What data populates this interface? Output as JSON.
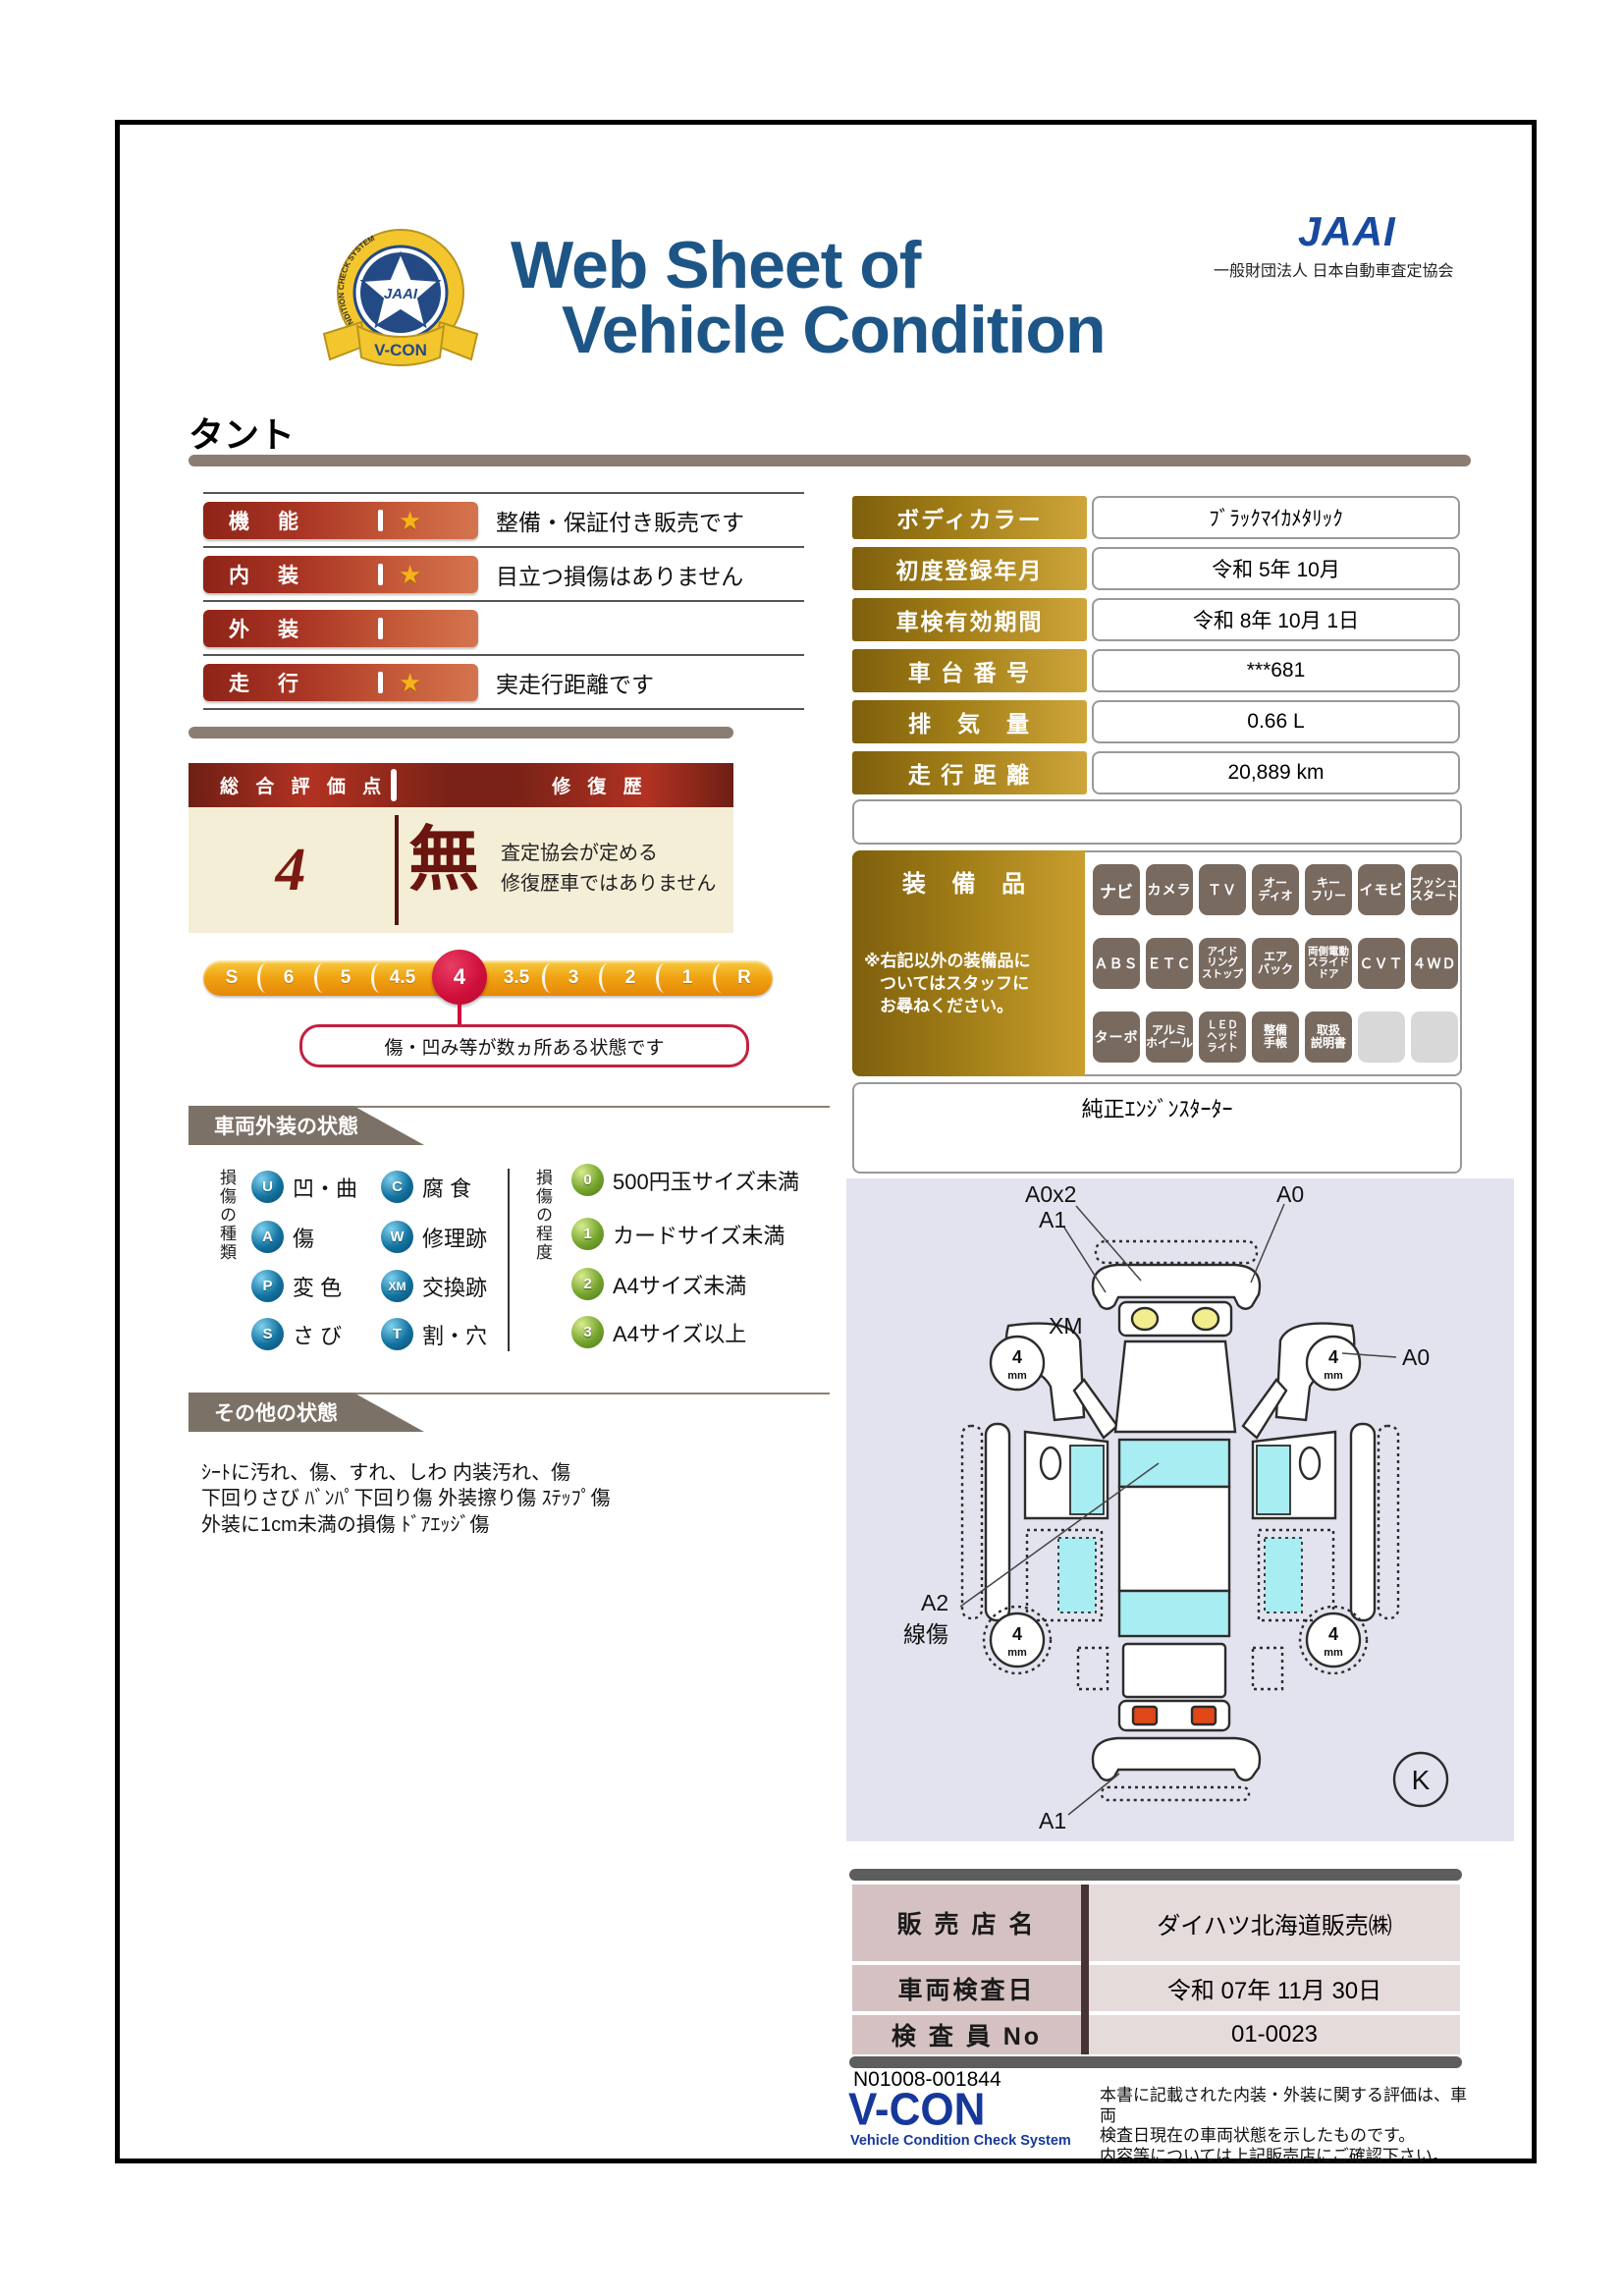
{
  "header": {
    "title_line1": "Web Sheet of",
    "title_line2": "Vehicle Condition",
    "jaai_logo": "JAAI",
    "jaai_subtitle": "一般財団法人 日本自動車査定協会",
    "badge": {
      "org": "JAAI",
      "ring_text": "VEHICLE CONDITION CHECK SYSTEM",
      "banner": "V-CON"
    }
  },
  "vehicle_name": "タント",
  "ratings": {
    "rows": [
      {
        "label": "機　能",
        "star": "★",
        "desc": "整備・保証付き販売です"
      },
      {
        "label": "内　装",
        "star": "★",
        "desc": "目立つ損傷はありません"
      },
      {
        "label": "外　装",
        "star": "",
        "desc": ""
      },
      {
        "label": "走　行",
        "star": "★",
        "desc": "実走行距離です"
      }
    ]
  },
  "summary": {
    "score_label": "総 合 評 価 点",
    "repair_label": "修 復 歴",
    "score": "4",
    "repair_value": "無",
    "repair_desc_line1": "査定協会が定める",
    "repair_desc_line2": "修復歴車ではありません"
  },
  "scale": {
    "items": [
      "S",
      "6",
      "5",
      "4.5",
      "4",
      "3.5",
      "3",
      "2",
      "1",
      "R"
    ],
    "selected": "4",
    "callout": "傷・凹み等が数ヵ所ある状態です"
  },
  "exterior": {
    "section_title": "車両外装の状態",
    "type_axis": "損傷の種類",
    "degree_axis": "損傷の程度",
    "types": [
      {
        "code": "U",
        "label": "凹・曲"
      },
      {
        "code": "C",
        "label": "腐 食"
      },
      {
        "code": "A",
        "label": "傷"
      },
      {
        "code": "W",
        "label": "修理跡"
      },
      {
        "code": "P",
        "label": "変 色"
      },
      {
        "code": "XM",
        "label": "交換跡"
      },
      {
        "code": "S",
        "label": "さ び"
      },
      {
        "code": "T",
        "label": "割・穴"
      }
    ],
    "degrees": [
      {
        "code": "0",
        "label": "500円玉サイズ未満"
      },
      {
        "code": "1",
        "label": "カードサイズ未満"
      },
      {
        "code": "2",
        "label": "A4サイズ未満"
      },
      {
        "code": "3",
        "label": "A4サイズ以上"
      }
    ]
  },
  "other": {
    "section_title": "その他の状態",
    "lines": [
      "ｼｰﾄに汚れ、傷、すれ、しわ 内装汚れ、傷",
      "下回りさび ﾊﾞﾝﾊﾟ下回り傷 外装擦り傷 ｽﾃｯﾌﾟ傷",
      "外装に1cm未満の損傷 ﾄﾞｱｴｯｼﾞ傷"
    ]
  },
  "info": {
    "rows": [
      {
        "label": "ボディカラー",
        "value": "ﾌﾞﾗｯｸﾏｲｶﾒﾀﾘｯｸ"
      },
      {
        "label": "初度登録年月",
        "value": "令和 5年 10月"
      },
      {
        "label": "車検有効期間",
        "value": "令和 8年 10月 1日"
      },
      {
        "label": "車 台 番 号",
        "value": "***681"
      },
      {
        "label": "排　気　量",
        "value": "0.66 L"
      },
      {
        "label": "走 行 距 離",
        "value": "20,889 km"
      }
    ]
  },
  "equipment": {
    "title": "装 備 品",
    "note_line1": "※右記以外の装備品に",
    "note_line2": "ついてはスタッフに",
    "note_line3": "お尋ねください。",
    "items": [
      {
        "label": "ナビ",
        "active": true
      },
      {
        "label": "カメラ",
        "active": true
      },
      {
        "label": "ＴＶ",
        "active": true
      },
      {
        "label": "オー\nディオ",
        "active": true
      },
      {
        "label": "キー\nフリー",
        "active": true
      },
      {
        "label": "イモビ",
        "active": true
      },
      {
        "label": "プッシュ\nスタート",
        "active": true
      },
      {
        "label": "ＡＢＳ",
        "active": true
      },
      {
        "label": "ＥＴＣ",
        "active": true
      },
      {
        "label": "アイド\nリング\nストップ",
        "active": true
      },
      {
        "label": "エア\nバック",
        "active": true
      },
      {
        "label": "両側電動\nスライド\nドア",
        "active": true
      },
      {
        "label": "ＣＶＴ",
        "active": true
      },
      {
        "label": "４ＷＤ",
        "active": true
      },
      {
        "label": "ターボ",
        "active": true
      },
      {
        "label": "アルミ\nホイール",
        "active": true
      },
      {
        "label": "ＬＥＤ\nヘッド\nライト",
        "active": true
      },
      {
        "label": "整備\n手帳",
        "active": true
      },
      {
        "label": "取扱\n説明書",
        "active": true
      },
      {
        "label": "",
        "active": false
      },
      {
        "label": "",
        "active": false
      }
    ],
    "extra": "純正ｴﾝｼﾞﾝｽﾀｰﾀｰ"
  },
  "diagram": {
    "label_front_top": "A0x2",
    "label_front_left": "A1",
    "label_front_right": "A0",
    "label_fender": "XM",
    "label_wheel_right": "A0",
    "label_roof": "A2",
    "label_roof_sub": "線傷",
    "label_rear": "A1",
    "label_corner": "K",
    "wheel_value": "4",
    "wheel_unit": "mm"
  },
  "dealer": {
    "rows": [
      {
        "label": "販 売 店 名",
        "value": "ダイハツ北海道販売㈱"
      },
      {
        "label": "車両検査日",
        "value": "令和 07年 11月 30日"
      },
      {
        "label": "検 査 員 No",
        "value": "01-0023"
      }
    ]
  },
  "footer": {
    "doc_no": "N01008-001844",
    "vcon": "V-CON",
    "vcon_sub": "Vehicle Condition Check System",
    "disclaimer_line1": "本書に記載された内装・外装に関する評価は、車両",
    "disclaimer_line2": "検査日現在の車両状態を示したものです。",
    "disclaimer_line3": "内容等については上記販売店にご確認下さい。"
  },
  "colors": {
    "title_navy": "#1d5586",
    "rating_red": "#8e2418",
    "gold": "#a37f18",
    "selected_crimson": "#ce0e3a",
    "section_gray": "#7c7166",
    "diagram_cyan": "#a8edf1",
    "diagram_bg": "#e3e3ef"
  }
}
